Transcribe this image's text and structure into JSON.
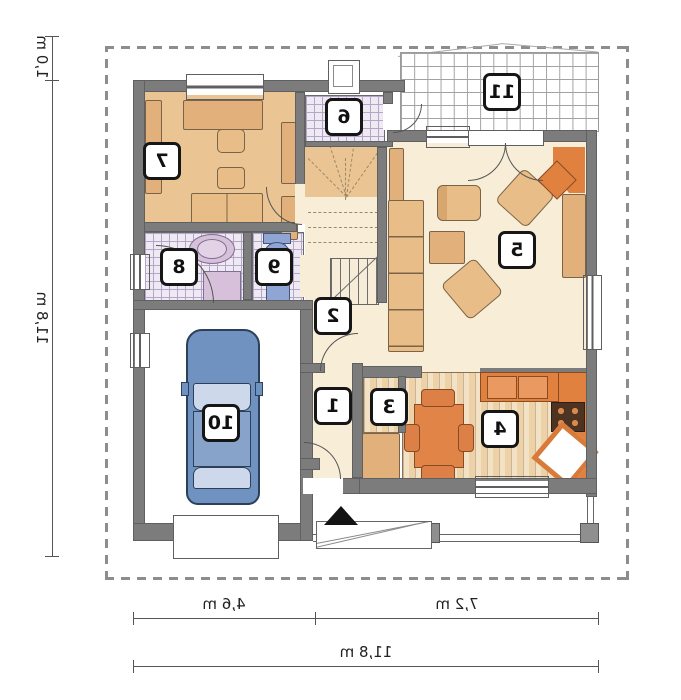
{
  "rooms": {
    "r1": "1",
    "r2": "2",
    "r3": "3",
    "r4": "4",
    "r5": "5",
    "r6": "6",
    "r7": "7",
    "r8": "8",
    "r9": "9",
    "r10": "10",
    "r11": "11"
  },
  "dimensions": {
    "top_setback": "1,0 m",
    "left_total": "11,8 m",
    "bottom_left": "4,6 m",
    "bottom_right": "7,2 m",
    "bottom_total": "11,8 m"
  },
  "colors": {
    "wall_gray": "#7c7c7c",
    "floor_cream": "#f8eed8",
    "floor_tan": "#ebc493",
    "wood_plank": "#ecd2a6",
    "accent_orange": "#e0813f",
    "tile_line_lilac": "#b3a6c6",
    "car_blue": "#6f92c0",
    "fixture_blue": "#8fa6d4",
    "fixture_lilac": "#d6c0da",
    "dashed_boundary": "#8d8d8d"
  }
}
